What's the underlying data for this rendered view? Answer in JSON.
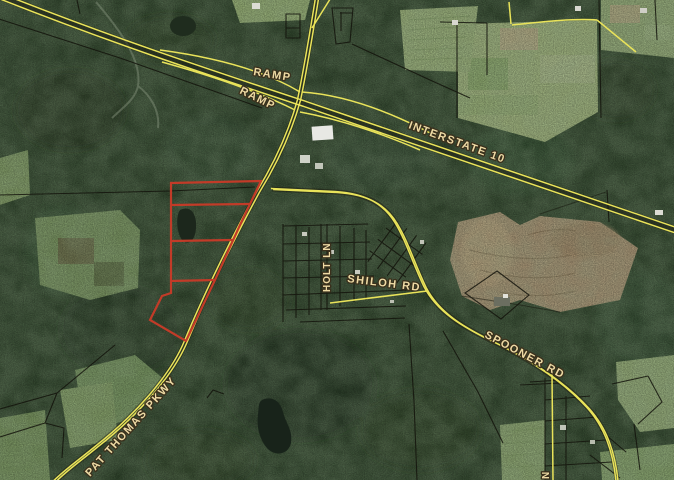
{
  "window": {
    "width": 674,
    "height": 480
  },
  "map": {
    "labels": {
      "ramp_upper": "RAMP",
      "ramp_lower": "RAMP",
      "interstate": "INTERSTATE 10",
      "shiloh": "SHILOH RD",
      "spooner": "SPOONER RD",
      "pat_thomas": "PAT THOMAS PKWY",
      "holt": "HOLT LN",
      "edge_partial": "N"
    },
    "colors": {
      "road_yellow": "#e9e35a",
      "parcel_line": "#14140c",
      "highlight_red": "#c23b28",
      "label_fill": "#eddaa4",
      "label_outline": "#3a301c",
      "forest_green": "#33492f",
      "field_green": "#9fb87e",
      "field_tan": "#b39c7b",
      "water_dark": "#18231a"
    }
  }
}
